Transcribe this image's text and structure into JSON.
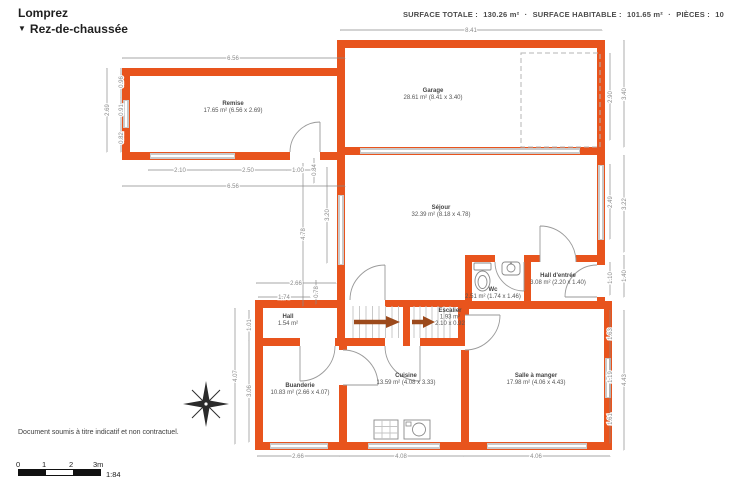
{
  "header": {
    "title": "Lomprez",
    "floor_name": "Rez-de-chaussée",
    "dropdown_icon": "▼",
    "summary": {
      "surface_totale_label": "SURFACE TOTALE :",
      "surface_totale": "130.26 m²",
      "separator": "·",
      "surface_habitable_label": "SURFACE HABITABLE :",
      "surface_habitable": "101.65 m²",
      "pieces_label": "PIÈCES :",
      "pieces": "10"
    }
  },
  "rooms": [
    {
      "name": "Remise",
      "detail": "17.65 m² (6.56 x 2.69)"
    },
    {
      "name": "Garage",
      "detail": "28.61 m² (8.41 x 3.40)"
    },
    {
      "name": "Séjour",
      "detail": "32.39 m² (8.18 x 4.78)"
    },
    {
      "name": "Wc",
      "detail": "2.51 m² (1.74 x 1.46)"
    },
    {
      "name": "Hall d'entrée",
      "detail": "3.08 m² (2.20 x 1.40)"
    },
    {
      "name": "Hall",
      "detail": "1.54 m²"
    },
    {
      "name": "Escalier",
      "detail": "1.93 m²",
      "dims": "2.10 x 0.92"
    },
    {
      "name": "Buanderie",
      "detail": "10.83 m² (2.66 x 4.07)"
    },
    {
      "name": "Cuisine",
      "detail": "13.59 m² (4.08 x 3.33)"
    },
    {
      "name": "Salle à manger",
      "detail": "17.98 m² (4.06 x 4.43)"
    }
  ],
  "dims": {
    "top_garage": "8.41",
    "top_remise": "6.56",
    "remise_left_total": "2.69",
    "remise_left_a": "0.96",
    "remise_left_b": "0.91",
    "remise_left_c": "0.82",
    "remise_bottom_a": "2.10",
    "remise_bottom_b": "2.50",
    "remise_bottom_c": "1.00",
    "remise_bottom_total": "6.56",
    "wall_gap": "0.84",
    "garage_right_inner": "2.90",
    "garage_right_outer": "3.40",
    "sejour_right_inner": "2.49",
    "sejour_right_outer": "3.22",
    "entree_right_inner": "1.10",
    "entree_right_outer": "1.40",
    "salle_right_a": "1.63",
    "salle_right_b": "1.19",
    "salle_right_c": "1.61",
    "salle_right_outer": "4.43",
    "sejour_left_outer": "4.78",
    "sejour_left_inner": "3.20",
    "hall_width_outer": "2.66",
    "hall_width_inner": "1.74",
    "hall_height": "0.78",
    "buanderie_left_a": "1.01",
    "buanderie_left_b": "3.06",
    "buanderie_left_outer": "4.07",
    "bottom_a": "2.66",
    "bottom_b": "4.08",
    "bottom_c": "4.06"
  },
  "footer": {
    "disclaimer": "Document soumis à titre indicatif et non contractuel."
  },
  "scale": {
    "t0": "0",
    "t1": "1",
    "t2": "2",
    "t3": "3m",
    "ratio": "1:84"
  },
  "colors": {
    "wall": "#E8541D",
    "window": "#C9C9C9",
    "dimension_text": "#8A8A8A",
    "stairs_arrow": "#9C4A1C"
  }
}
